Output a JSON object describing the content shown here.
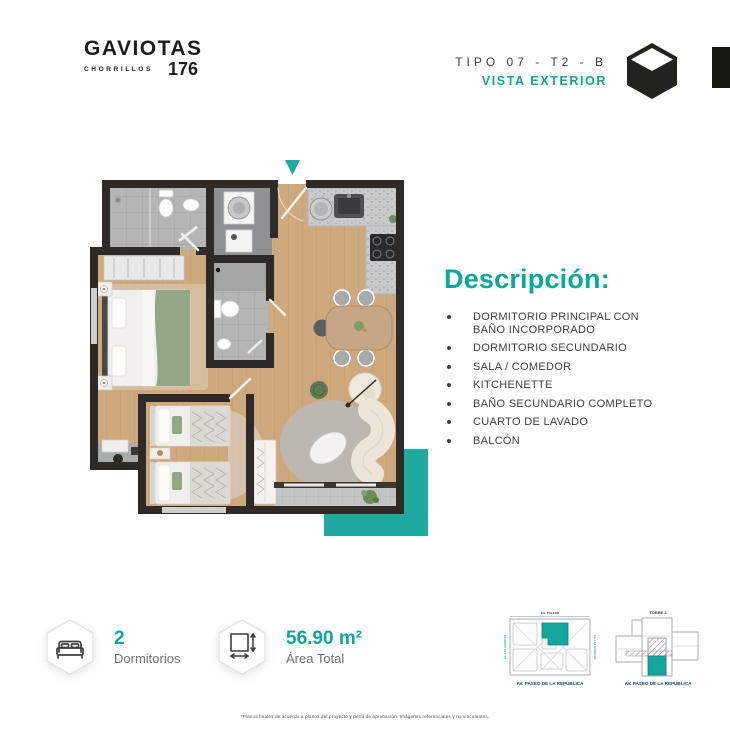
{
  "brand": {
    "name": "GAVIOTAS",
    "district": "CHORRILLOS",
    "number": "176"
  },
  "header": {
    "type_label": "TIPO 07 - T2 - B",
    "view_label": "VISTA EXTERIOR",
    "icons": {
      "cube": "cube-icon",
      "edge_bar": "black-edge-bar"
    }
  },
  "plan": {
    "entrance_marker": "triangle-down-icon",
    "accent_color": "#1FA9A0",
    "rooms_depicted": "dormitorio principal, dormitorio secundario, banos, lavanderia, kitchenette, sala comedor, balcon"
  },
  "description": {
    "title": "Descripción:",
    "items": [
      "DORMITORIO PRINCIPAL CON BAÑO INCORPORADO",
      "DORMITORIO SECUNDARIO",
      "SALA / COMEDOR",
      "KITCHENETTE",
      "BAÑO SECUNDARIO COMPLETO",
      "CUARTO DE LAVADO",
      "BALCÓN"
    ]
  },
  "stats": [
    {
      "icon": "bed-icon",
      "value": "2",
      "label": "Dormitorios"
    },
    {
      "icon": "area-icon",
      "value": "56.90 m²",
      "label": "Área Total"
    }
  ],
  "keyplans": {
    "site": {
      "top_label": "CA. TOLEDO",
      "left_label": "CA. LAS GAVIOTAS",
      "right_label": "CA. LAS GAVIOTAS",
      "bottom_label": "AV. PASEO DE LA REPÚBLICA"
    },
    "tower": {
      "title": "TORRE 2",
      "bottom_label": "AV. PASEO DE LA REPÚBLICA"
    }
  },
  "disclaimer": "*Planos finales de acuerdo a planos del proyecto y perfil de aprobación. Imágenes referenciales y no vinculantes.",
  "colors": {
    "teal": "#0DA79C",
    "wall_dark": "#2D2A27",
    "text_dark": "#3E3E3D",
    "text_gray": "#6E6E6E"
  }
}
